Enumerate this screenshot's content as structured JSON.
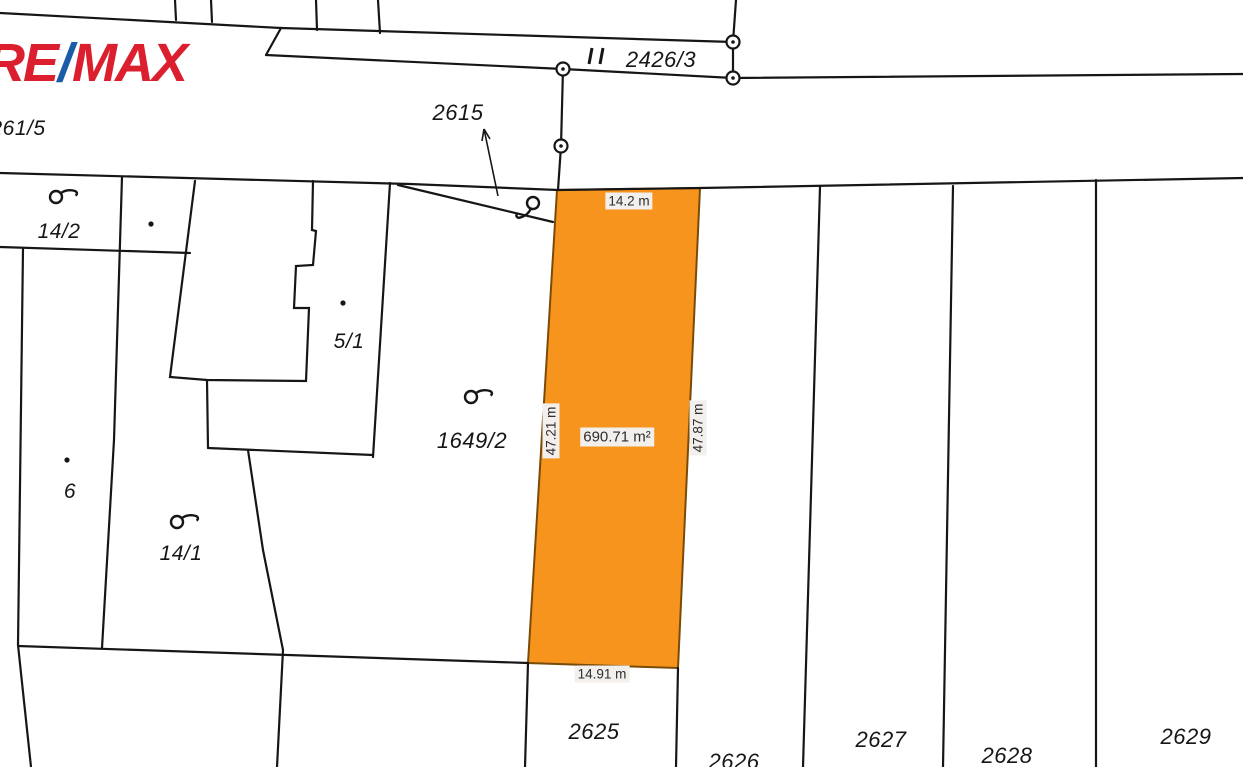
{
  "brand": {
    "re": "RE",
    "slash": "/",
    "max": "MAX",
    "red": "#DC1F2E",
    "blue": "#1B5CA8"
  },
  "map": {
    "highlight_color": "#F7941E",
    "line_color": "#161616",
    "parcel_labels": {
      "p261_5": "261/5",
      "p2615": "2615",
      "p2426_3": "2426/3",
      "p14_2": "14/2",
      "p5_1": "5/1",
      "p1649_2": "1649/2",
      "p6": "6",
      "p14_1": "14/1",
      "p2625": "2625",
      "p2626": "2626",
      "p2627": "2627",
      "p2628": "2628",
      "p2629": "2629"
    },
    "measurements": {
      "top": "14.2 m",
      "bottom": "14.91 m",
      "left_side": "47.21 m",
      "right_side": "47.87 m",
      "area": "690.71 m²"
    },
    "icons": {
      "survey_point": "double-circle",
      "land_use": "circle-with-pennant",
      "parcel_dot": "filled-dot",
      "label_pointer": "arrow",
      "road_marker": "double-tick"
    }
  }
}
